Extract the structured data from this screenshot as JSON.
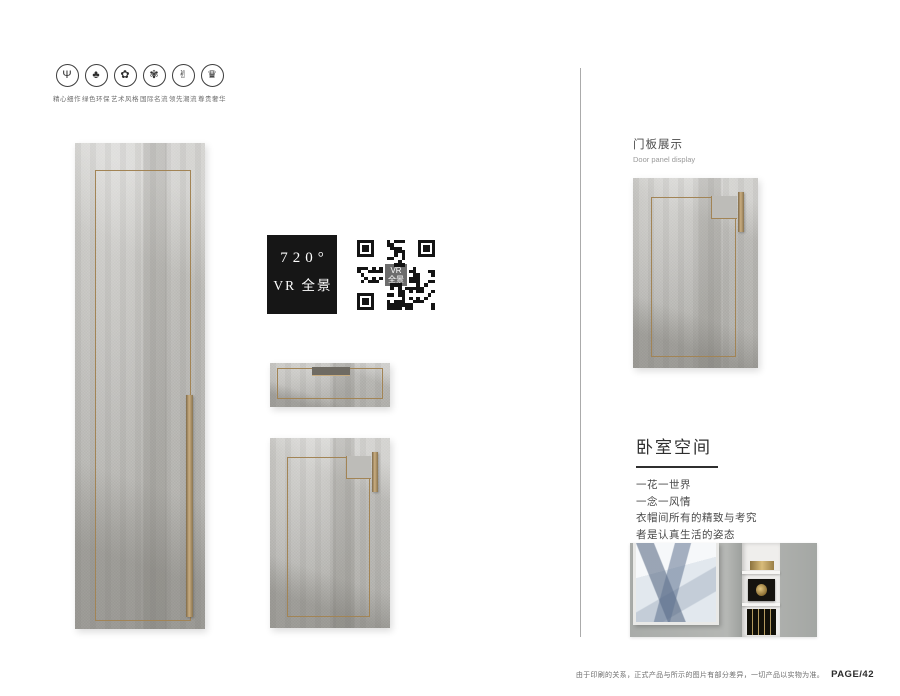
{
  "features": {
    "items": [
      {
        "label": "精心细作",
        "icon": "trophy-icon",
        "glyph": "Ψ"
      },
      {
        "label": "绿色环保",
        "icon": "tree-icon",
        "glyph": "♣"
      },
      {
        "label": "艺术风格",
        "icon": "art-flower-icon",
        "glyph": "✿"
      },
      {
        "label": "国际名流",
        "icon": "medal-flower-icon",
        "glyph": "✾"
      },
      {
        "label": "领先潮流",
        "icon": "hands-icon",
        "glyph": "✌"
      },
      {
        "label": "尊贵奢华",
        "icon": "crown-icon",
        "glyph": "♛"
      }
    ]
  },
  "vr": {
    "line1": "720°",
    "line2": "VR 全景",
    "qr_label_line1": "VR",
    "qr_label_line2": "全景"
  },
  "right_column": {
    "section1_title_zh": "门板展示",
    "section1_title_en": "Door panel display",
    "section2_title": "卧室空间",
    "poem_lines": [
      "一花一世界",
      "一念一风情",
      "衣帽间所有的精致与考究",
      "者是认真生活的姿态"
    ]
  },
  "footer": {
    "note": "由于印刷的关系，正式产品与所示的图片有部分差异，一切产品以实物为准。",
    "page_number": "PAGE/42"
  },
  "colors": {
    "accent_gold": "#a28455",
    "panel_grey": "#bdbcb8",
    "vr_black": "#161616"
  }
}
